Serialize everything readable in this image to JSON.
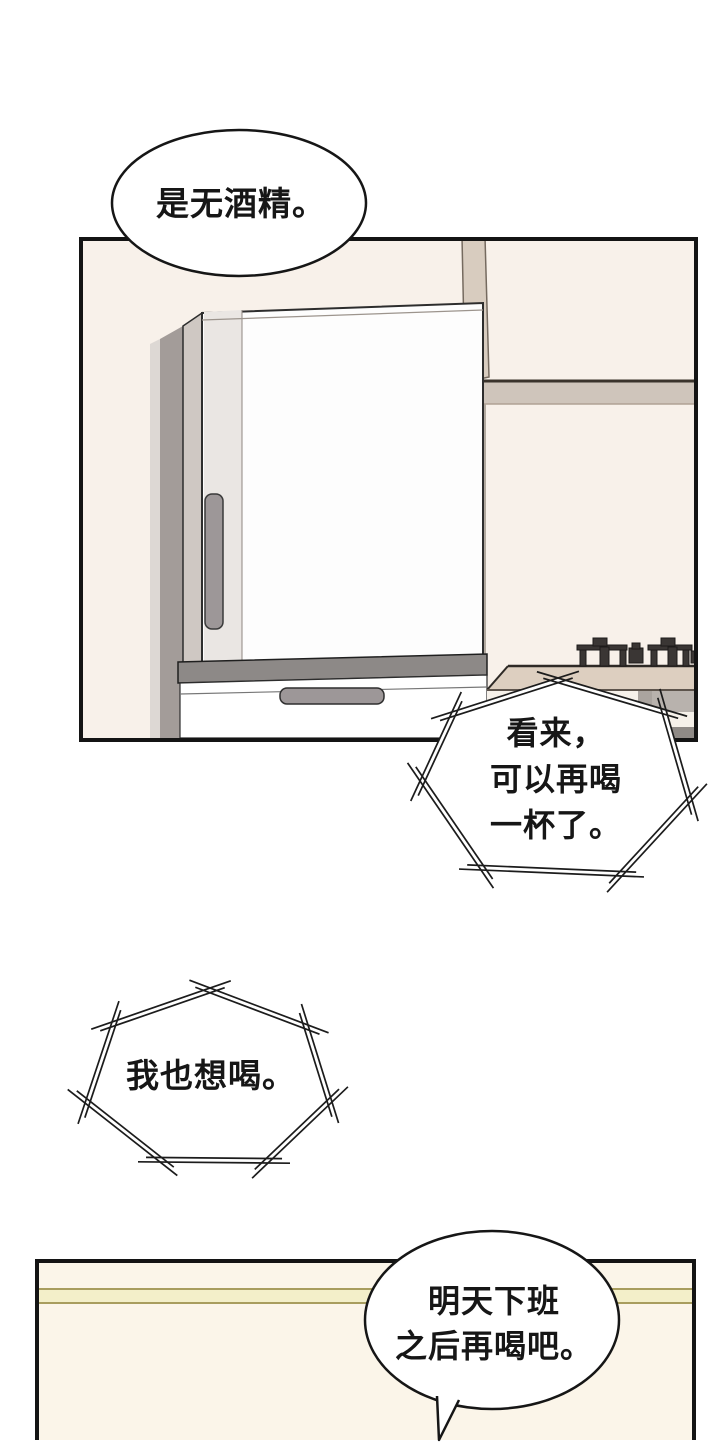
{
  "page": {
    "background": "#ffffff"
  },
  "colors": {
    "ink": "#141414",
    "panel_bg": "#f8f1ea",
    "panel3_bg": "#fbf5e9",
    "stripe_fill": "#f3efc9",
    "stripe_edge": "#a89d5e",
    "strip_light": "#ddd8d4",
    "strip_dark": "#a39c99",
    "fridge_side": "#cfc8c3",
    "fridge_door": "#fdfdfd",
    "door_inner": "#eae6e3",
    "handle": "#9d9798",
    "trim": "#8d8987",
    "duct": "#d8ccbf",
    "cabinet_band": "#cfc5bb",
    "counter": "#ddcfc0",
    "burner": "#3a3634",
    "under_shadow": "#8f8a86",
    "under_strip": "#aaa49f"
  },
  "bubbles": {
    "b1": {
      "text": "是无酒精。"
    },
    "b2": {
      "lines": [
        "看来，",
        "可以再喝",
        "一杯了。"
      ]
    },
    "b3": {
      "text": "我也想喝。"
    },
    "b4": {
      "lines": [
        "明天下班",
        "之后再喝吧。"
      ]
    }
  }
}
